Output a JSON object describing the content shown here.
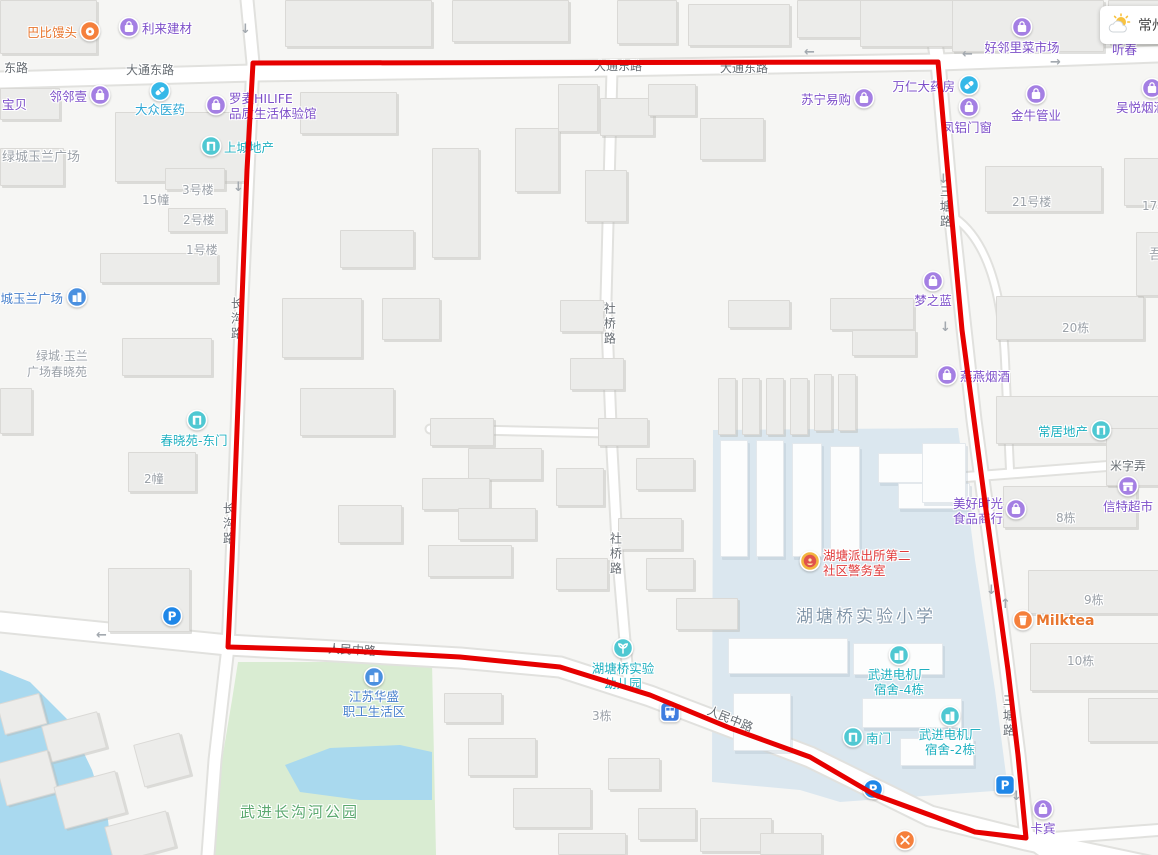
{
  "weather": {
    "city": "常州"
  },
  "boundary": {
    "color": "#e60000",
    "points": "253,63 938,62 944,130 952,220 962,330 974,420 986,510 997,590 1008,670 1018,755 1026,838 975,832 930,815 875,795 810,757 730,728 650,695 560,667 460,657 330,650 228,647 232,560 237,430 242,300 247,170 253,63"
  },
  "road_labels": [
    {
      "text": "东路",
      "x": 4,
      "y": 61
    },
    {
      "text": "大通东路",
      "x": 126,
      "y": 63
    },
    {
      "text": "大通东路",
      "x": 594,
      "y": 59
    },
    {
      "text": "大通东路",
      "x": 720,
      "y": 61
    },
    {
      "text": "人民中路",
      "x": 328,
      "y": 643,
      "rot": 3
    },
    {
      "text": "人民中路",
      "x": 706,
      "y": 712,
      "rot": 22
    },
    {
      "text": "米字弄",
      "x": 1110,
      "y": 459
    },
    {
      "text": "长沟路",
      "x": 229,
      "y": 297,
      "vert": true
    },
    {
      "text": "长沟路",
      "x": 221,
      "y": 502,
      "vert": true
    },
    {
      "text": "社桥路",
      "x": 602,
      "y": 302,
      "vert": true
    },
    {
      "text": "社桥路",
      "x": 608,
      "y": 532,
      "vert": true
    },
    {
      "text": "三塘路",
      "x": 938,
      "y": 185,
      "vert": true
    },
    {
      "text": "三塘路",
      "x": 1001,
      "y": 694,
      "vert": true
    }
  ],
  "place_labels": [
    {
      "text": "绿城玉兰广场",
      "x": 2,
      "y": 150,
      "size": 13
    },
    {
      "text": "15幢",
      "x": 142,
      "y": 193
    },
    {
      "text": "3号楼",
      "x": 182,
      "y": 183
    },
    {
      "text": "2号楼",
      "x": 183,
      "y": 213
    },
    {
      "text": "1号楼",
      "x": 186,
      "y": 243
    },
    {
      "text": "绿城·玉兰",
      "x": 36,
      "y": 349
    },
    {
      "text": "广场春晓苑",
      "x": 27,
      "y": 365
    },
    {
      "text": "2幢",
      "x": 144,
      "y": 472
    },
    {
      "text": "21号楼",
      "x": 1012,
      "y": 195
    },
    {
      "text": "17栋",
      "x": 1142,
      "y": 199
    },
    {
      "text": "吾",
      "x": 1149,
      "y": 247,
      "size": 14
    },
    {
      "text": "20栋",
      "x": 1062,
      "y": 321
    },
    {
      "text": "8栋",
      "x": 1056,
      "y": 511
    },
    {
      "text": "9栋",
      "x": 1084,
      "y": 593
    },
    {
      "text": "10栋",
      "x": 1067,
      "y": 654
    },
    {
      "text": "3栋",
      "x": 592,
      "y": 709
    },
    {
      "text": "湖塘桥实验小学",
      "x": 796,
      "y": 607,
      "color": "#8296a9",
      "size": 17,
      "ls": 3
    },
    {
      "text": "武进长沟河公园",
      "x": 240,
      "y": 803,
      "color": "#5aa86e",
      "size": 15,
      "ls": 2
    }
  ],
  "pois": [
    {
      "label": [
        "巴比馒头"
      ],
      "color": "orange",
      "icon": "bun",
      "ix": 90,
      "iy": 33,
      "lx": 77,
      "ly": 26,
      "align": "r"
    },
    {
      "label": [
        "利来建材"
      ],
      "color": "purple",
      "icon": "bag",
      "ix": 129,
      "iy": 29,
      "lx": 142,
      "ly": 22,
      "align": "l"
    },
    {
      "label": [
        "邻邻壹"
      ],
      "color": "purple",
      "icon": "bag",
      "ix": 100,
      "iy": 97,
      "lx": 87,
      "ly": 90,
      "align": "r"
    },
    {
      "label": [
        "宝贝"
      ],
      "color": "purple",
      "lx": 2,
      "ly": 98,
      "align": "l"
    },
    {
      "label": [
        "大众医药"
      ],
      "color": "tealblue",
      "icon": "pill",
      "ix": 160,
      "iy": 93,
      "lx": 160,
      "ly": 103,
      "align": "c"
    },
    {
      "label": [
        "罗麦HILIFE",
        "品质生活体验馆"
      ],
      "color": "purple",
      "icon": "bag",
      "ix": 216,
      "iy": 107,
      "lx": 229,
      "ly": 92,
      "align": "l"
    },
    {
      "label": [
        "上城地产"
      ],
      "color": "teal",
      "icon": "door",
      "ix": 211,
      "iy": 148,
      "lx": 224,
      "ly": 141,
      "align": "l"
    },
    {
      "label": [
        "苏宁易购"
      ],
      "color": "purple",
      "icon": "bag",
      "ix": 864,
      "iy": 100,
      "lx": 851,
      "ly": 93,
      "align": "r"
    },
    {
      "label": [
        "好邻里菜市场"
      ],
      "color": "purple",
      "icon": "bag",
      "ix": 1022,
      "iy": 29,
      "lx": 1022,
      "ly": 41,
      "align": "c"
    },
    {
      "label": [
        "听春"
      ],
      "color": "purple",
      "lx": 1112,
      "ly": 43,
      "align": "l"
    },
    {
      "label": [
        "万仁大药房"
      ],
      "color": "purple",
      "icon": "pill",
      "ix": 969,
      "iy": 87,
      "lx": 955,
      "ly": 80,
      "align": "r"
    },
    {
      "label": [
        "凤铝门窗"
      ],
      "color": "purple",
      "icon": "bag",
      "ix": 969,
      "iy": 109,
      "lx": 967,
      "ly": 121,
      "align": "c"
    },
    {
      "label": [
        "金牛管业"
      ],
      "color": "purple",
      "icon": "bag",
      "ix": 1036,
      "iy": 96,
      "lx": 1036,
      "ly": 109,
      "align": "c"
    },
    {
      "label": [
        "吴悦烟酒"
      ],
      "color": "purple",
      "icon": "bag",
      "ix": 1152,
      "iy": 90,
      "lx": 1116,
      "ly": 101,
      "align": "l"
    },
    {
      "label": [
        "梦之蓝"
      ],
      "color": "purple",
      "icon": "bag",
      "ix": 933,
      "iy": 283,
      "lx": 933,
      "ly": 294,
      "align": "c"
    },
    {
      "label": [
        "燕燕烟酒"
      ],
      "color": "purple",
      "icon": "bag",
      "ix": 947,
      "iy": 377,
      "lx": 960,
      "ly": 370,
      "align": "l"
    },
    {
      "label": [
        "常居地产"
      ],
      "color": "teal",
      "icon": "door",
      "ix": 1101,
      "iy": 432,
      "lx": 1088,
      "ly": 425,
      "align": "r"
    },
    {
      "label": [
        "美好时光",
        "食品商行"
      ],
      "color": "purple",
      "icon": "bag",
      "ix": 1016,
      "iy": 511,
      "lx": 1003,
      "ly": 497,
      "align": "r"
    },
    {
      "label": [
        "信特超市"
      ],
      "color": "purple",
      "icon": "shop",
      "ix": 1128,
      "iy": 488,
      "lx": 1128,
      "ly": 500,
      "align": "c"
    },
    {
      "label": [
        "绿城玉兰广场"
      ],
      "color": "blue",
      "icon": "community",
      "ix": 77,
      "iy": 299,
      "lx": 63,
      "ly": 292,
      "align": "r"
    },
    {
      "label": [
        "春晓苑-东门"
      ],
      "color": "teal",
      "icon": "door",
      "ix": 197,
      "iy": 422,
      "lx": 194,
      "ly": 434,
      "align": "c"
    },
    {
      "label": [
        "江苏华盛",
        "职工生活区"
      ],
      "color": "blue",
      "icon": "community",
      "ix": 374,
      "iy": 679,
      "lx": 374,
      "ly": 690,
      "align": "c"
    },
    {
      "label": [
        "湖塘桥实验",
        "幼儿园"
      ],
      "color": "teal",
      "icon": "sprout",
      "ix": 623,
      "iy": 650,
      "lx": 623,
      "ly": 662,
      "align": "c"
    },
    {
      "label": [
        "湖塘派出所第二",
        "社区警务室"
      ],
      "color": "red",
      "icon": "badge",
      "ix": 810,
      "iy": 563,
      "lx": 823,
      "ly": 549,
      "align": "l"
    },
    {
      "label": [
        "武进电机厂",
        "宿舍-4栋"
      ],
      "color": "teal",
      "icon": "dorm",
      "ix": 899,
      "iy": 657,
      "lx": 899,
      "ly": 668,
      "align": "c"
    },
    {
      "label": [
        "南门"
      ],
      "color": "teal",
      "icon": "door",
      "ix": 853,
      "iy": 739,
      "lx": 866,
      "ly": 732,
      "align": "l"
    },
    {
      "label": [
        "武进电机厂",
        "宿舍-2栋"
      ],
      "color": "teal",
      "icon": "dorm",
      "ix": 950,
      "iy": 718,
      "lx": 950,
      "ly": 728,
      "align": "c"
    },
    {
      "label": [],
      "icon": "parking",
      "ix": 172,
      "iy": 618
    },
    {
      "label": [],
      "icon": "parking",
      "ix": 873,
      "iy": 791
    },
    {
      "label": [],
      "icon": "parking-sq",
      "ix": 1005,
      "iy": 787
    },
    {
      "label": [],
      "icon": "restaurant",
      "ix": 905,
      "iy": 842
    },
    {
      "label": [
        "Milktea"
      ],
      "color": "orange",
      "icon": "cup",
      "ix": 1023,
      "iy": 622,
      "lx": 1036,
      "ly": 613,
      "align": "l",
      "size": 14,
      "bold": true
    },
    {
      "label": [
        "卡宾"
      ],
      "color": "purple",
      "icon": "bag",
      "ix": 1043,
      "iy": 811,
      "lx": 1043,
      "ly": 822,
      "align": "c"
    },
    {
      "label": [],
      "icon": "bus",
      "ix": 670,
      "iy": 714
    }
  ],
  "arrows": [
    {
      "g": "↓",
      "x": 240,
      "y": 22
    },
    {
      "g": "↓",
      "x": 233,
      "y": 180
    },
    {
      "g": "←",
      "x": 96,
      "y": 628
    },
    {
      "g": "←",
      "x": 804,
      "y": 45
    },
    {
      "g": "←",
      "x": 962,
      "y": 47
    },
    {
      "g": "→",
      "x": 1050,
      "y": 55
    },
    {
      "g": "↓",
      "x": 938,
      "y": 172
    },
    {
      "g": "↓",
      "x": 940,
      "y": 320
    },
    {
      "g": "↓",
      "x": 986,
      "y": 583
    },
    {
      "g": "↑",
      "x": 1000,
      "y": 597
    },
    {
      "g": "↓",
      "x": 1011,
      "y": 789
    }
  ]
}
